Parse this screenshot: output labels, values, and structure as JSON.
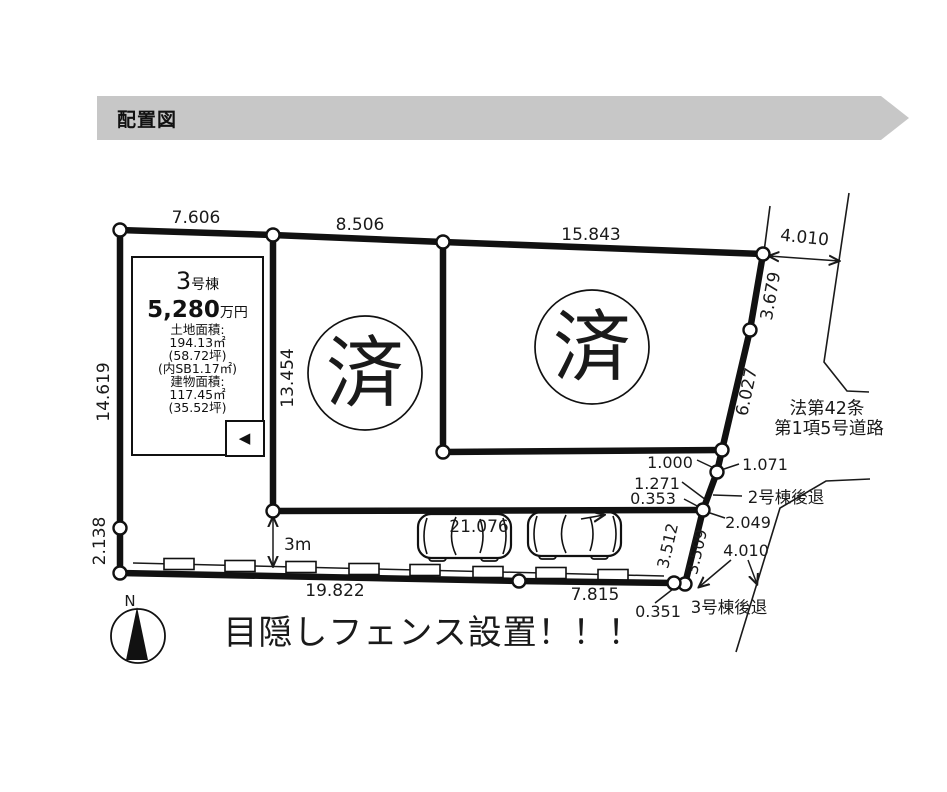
{
  "header": {
    "title": "配置図"
  },
  "info_box": {
    "unit_no": "3",
    "unit_suffix": "号棟",
    "price": "5,280",
    "price_unit": "万円",
    "land_label": "土地面積:",
    "land_m2": "194.13㎡",
    "land_tsubo": "(58.72坪)",
    "land_sb": "(内SB1.17㎡)",
    "bldg_label": "建物面積:",
    "bldg_m2": "117.45㎡",
    "bldg_tsubo": "(35.52坪)",
    "nav_arrow": "◀"
  },
  "sold_mark": "済",
  "dims": {
    "top_a": "7.606",
    "top_b": "8.506",
    "top_c": "15.843",
    "top_road": "4.010",
    "left_a": "14.619",
    "left_b": "2.138",
    "mid": "13.454",
    "right_a": "3.679",
    "right_b": "6.027",
    "seg_1000": "1.000",
    "seg_1071": "1.071",
    "seg_1271": "1.271",
    "seg_0353": "0.353",
    "seg_2049": "2.049",
    "seg_3512": "3.512",
    "seg_3509": "3.509",
    "road_4010": "4.010",
    "seg_0351": "0.351",
    "bottom_a": "19.822",
    "bottom_b": "7.815",
    "drive": "21.076",
    "setback": "3m"
  },
  "labels": {
    "road_line1": "法第42条",
    "road_line2": "第1項5号道路",
    "setback_2": "2号棟後退",
    "setback_3": "3号棟後退",
    "fence_note": "目隠しフェンス設置！！！",
    "north": "N"
  }
}
